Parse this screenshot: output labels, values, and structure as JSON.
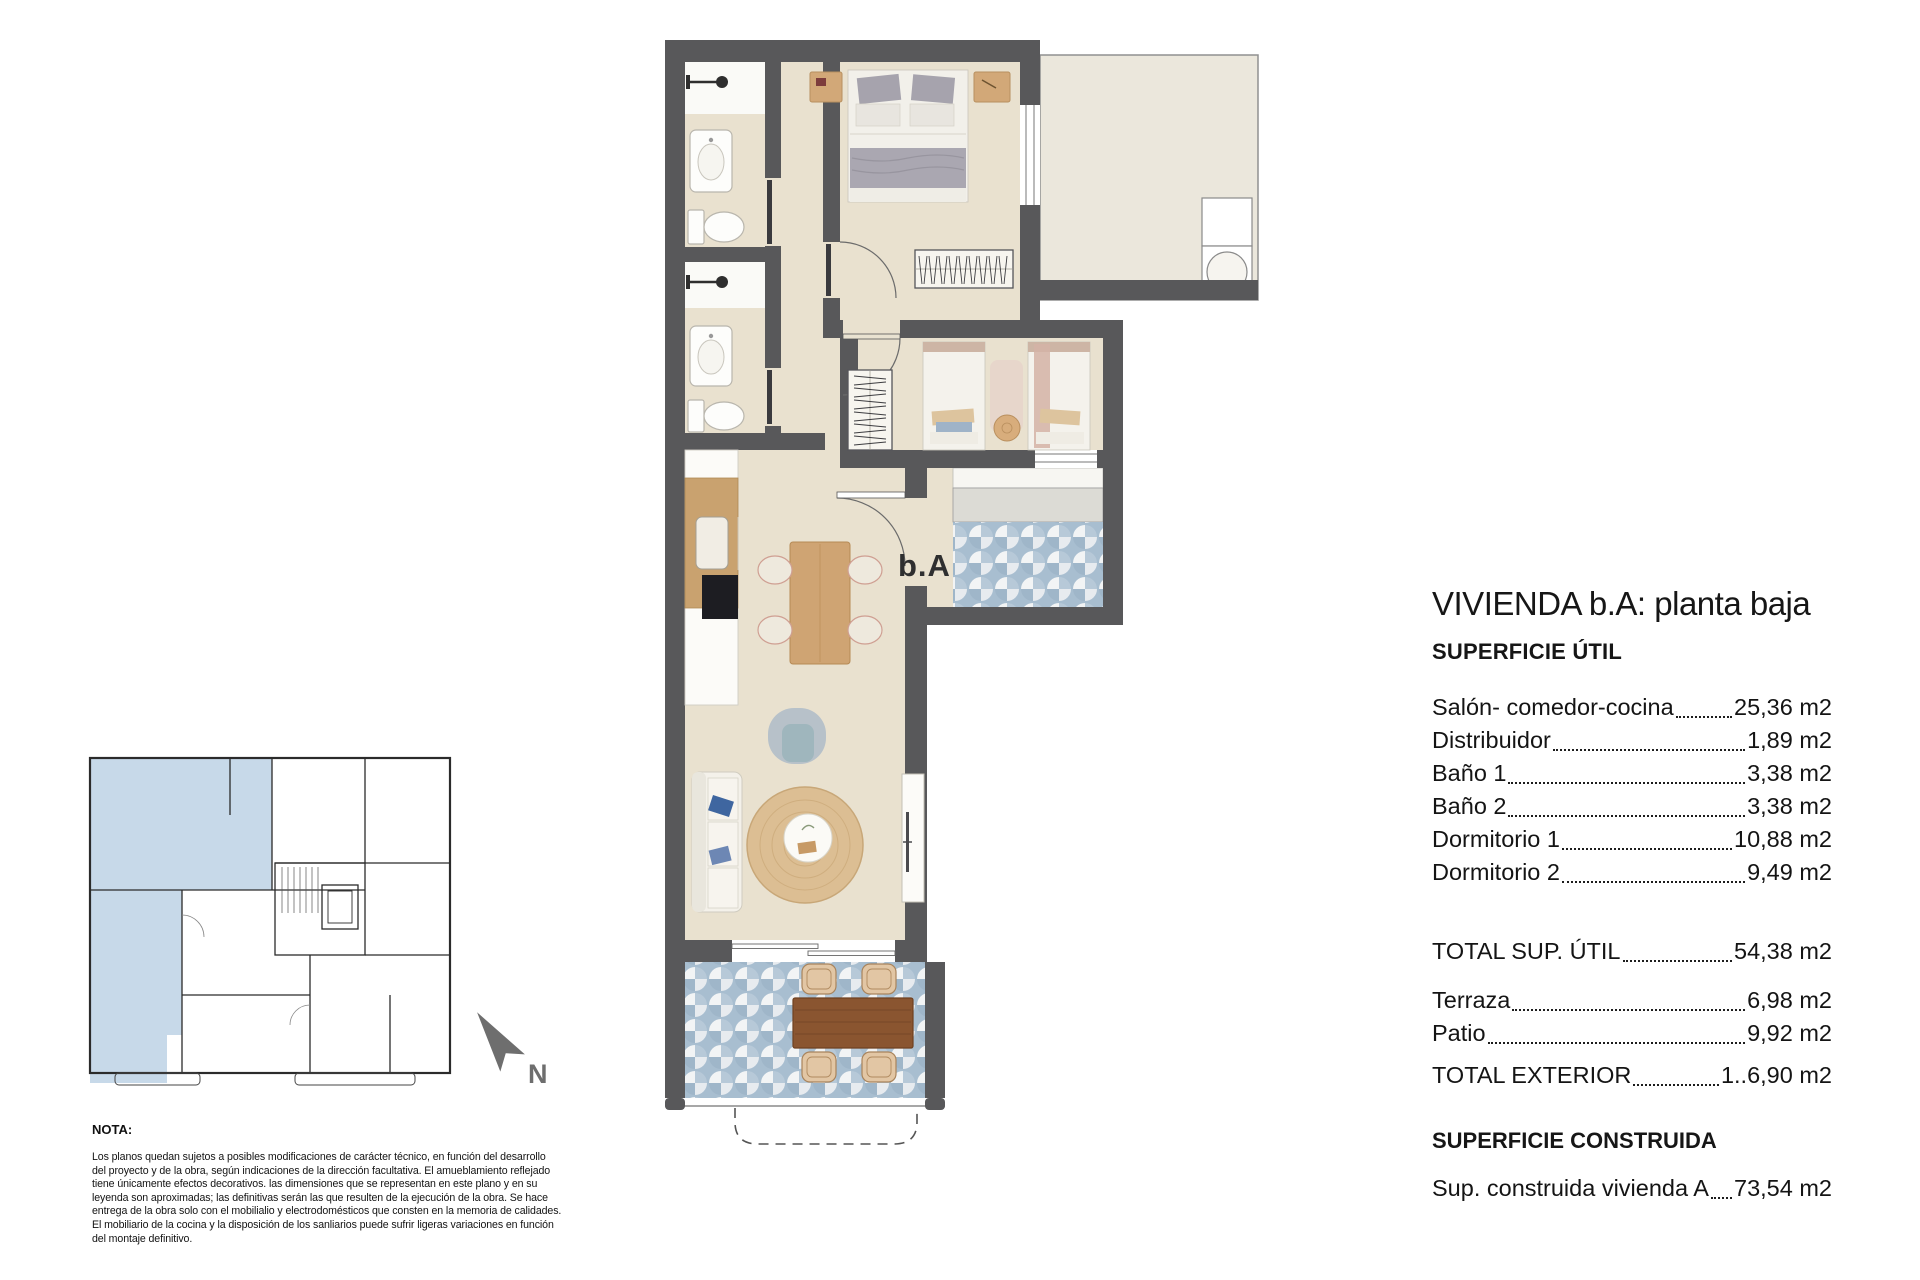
{
  "title_block": {
    "title": "VIVIENDA b.A: planta baja",
    "surface_util_heading": "SUPERFICIE ÚTIL",
    "util_rows": [
      {
        "label": "Salón- comedor-cocina",
        "value": "25,36 m2"
      },
      {
        "label": "Distribuidor",
        "value": "1,89 m2"
      },
      {
        "label": "Baño 1",
        "value": "3,38 m2"
      },
      {
        "label": "Baño 2",
        "value": "3,38 m2"
      },
      {
        "label": "Dormitorio 1",
        "value": "10,88 m2"
      },
      {
        "label": "Dormitorio 2",
        "value": "9,49 m2"
      }
    ],
    "total_util": {
      "label": "TOTAL SUP. ÚTIL",
      "value": "54,38 m2"
    },
    "exterior_rows": [
      {
        "label": "Terraza",
        "value": "6,98 m2"
      },
      {
        "label": "Patio",
        "value": "9,92 m2"
      }
    ],
    "total_exterior": {
      "label": "TOTAL EXTERIOR",
      "value": "1..6,90 m2"
    },
    "surface_built_heading": "SUPERFICIE CONSTRUIDA",
    "built_row": {
      "label": "Sup. construida vivienda A",
      "value": "73,54 m2"
    }
  },
  "plan": {
    "entry_label": "b.A",
    "north_label": "N"
  },
  "nota": {
    "heading": "NOTA:",
    "body": "Los planos quedan sujetos a posibles modificaciones de carácter técnico, en función del desarrollo\ndel proyecto y de la obra, según indicaciones de la dirección facultativa. El amueblamiento reflejado\ntiene únicamente efectos decorativos. las dimensiones que se representan en este plano y en su\nleyenda son aproximadas; las definitivas serán las que resulten de la ejecución de la obra. Se hace\nentrega de la obra solo con el mobilialio y electrodomésticos que consten en la memoria de calidades.\nEl mobiliario de la cocina y la disposición de los sanliarios puede sufrir ligeras variaciones en función\ndel montaje definitivo."
  },
  "colors": {
    "wall": "#58585a",
    "floor": "#e9e1cf",
    "tile_blue": "#a8bed0",
    "keyplan_blue": "#c7d9e9",
    "wood_light": "#cfa473",
    "wood_dark": "#8a5530",
    "north_gray": "#6e6e6e"
  }
}
